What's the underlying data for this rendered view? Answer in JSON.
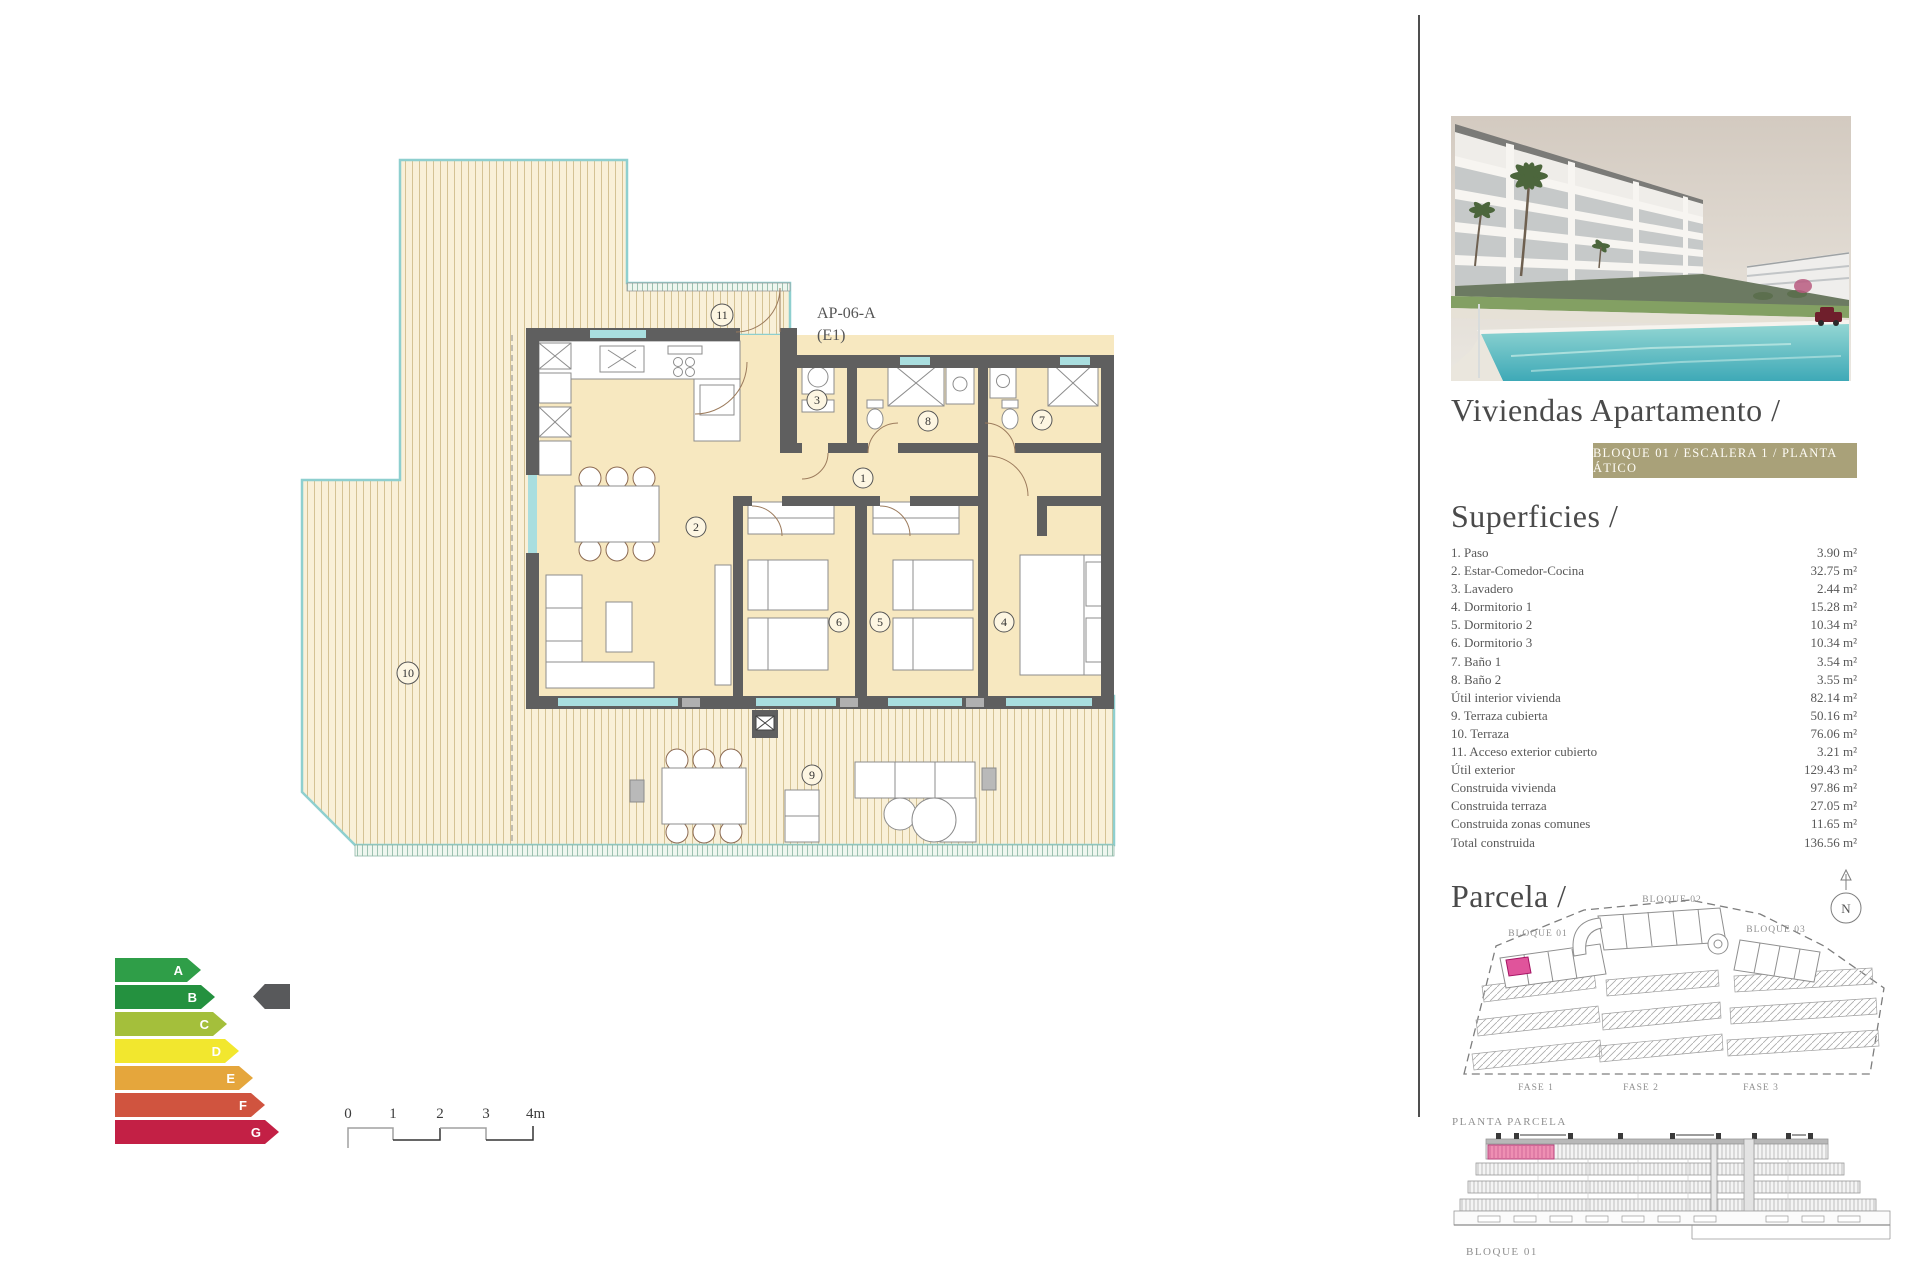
{
  "colors": {
    "badge_bg": "#a9a179",
    "highlight": "#e0549b",
    "highlight_light": "#ee8fb3",
    "wall": "#5f5f5f"
  },
  "plan": {
    "unit": "AP-06-A",
    "unit_floor": "(E1)",
    "numbers": [
      "1",
      "2",
      "3",
      "4",
      "5",
      "6",
      "7",
      "8",
      "9",
      "10",
      "11"
    ]
  },
  "energy": {
    "grades": [
      {
        "letter": "A",
        "color": "#2f9e48",
        "width": 86
      },
      {
        "letter": "B",
        "color": "#24913f",
        "width": 100
      },
      {
        "letter": "C",
        "color": "#a4bf3b",
        "width": 112
      },
      {
        "letter": "D",
        "color": "#f2e72e",
        "width": 124
      },
      {
        "letter": "E",
        "color": "#e5a63c",
        "width": 138
      },
      {
        "letter": "F",
        "color": "#d0543f",
        "width": 150
      },
      {
        "letter": "G",
        "color": "#c32045",
        "width": 164
      }
    ],
    "indicator_color": "#58595b",
    "rating": "B"
  },
  "scale": {
    "labels": [
      "0",
      "1",
      "2",
      "3",
      "4m"
    ]
  },
  "panel": {
    "title": "Viviendas Apartamento /",
    "badge": "BLOQUE 01 / ESCALERA 1 / PLANTA ÁTICO",
    "superficies": {
      "heading": "Superficies /",
      "rows": [
        {
          "label": "1. Paso",
          "value": "3.90 m²"
        },
        {
          "label": "2. Estar-Comedor-Cocina",
          "value": "32.75 m²"
        },
        {
          "label": "3. Lavadero",
          "value": "2.44 m²"
        },
        {
          "label": "4. Dormitorio 1",
          "value": "15.28 m²"
        },
        {
          "label": "5. Dormitorio 2",
          "value": "10.34 m²"
        },
        {
          "label": "6. Dormitorio 3",
          "value": "10.34 m²"
        },
        {
          "label": "7. Baño 1",
          "value": "3.54 m²"
        },
        {
          "label": "8. Baño 2",
          "value": "3.55 m²"
        },
        {
          "label": "Útil interior vivienda",
          "value": "82.14 m²"
        },
        {
          "label": "9. Terraza cubierta",
          "value": "50.16 m²"
        },
        {
          "label": "10. Terraza",
          "value": "76.06 m²"
        },
        {
          "label": "11. Acceso exterior cubierto",
          "value": "3.21 m²"
        },
        {
          "label": "Útil exterior",
          "value": "129.43 m²"
        },
        {
          "label": "Construida vivienda",
          "value": "97.86 m²"
        },
        {
          "label": "Construida terraza",
          "value": "27.05 m²"
        },
        {
          "label": "Construida zonas comunes",
          "value": "11.65 m²"
        },
        {
          "label": "Total construida",
          "value": "136.56 m²"
        }
      ]
    },
    "parcela": {
      "heading": "Parcela /",
      "blocks": [
        "BLOQUE 01",
        "BLOQUE 02",
        "BLOQUE 03"
      ],
      "fases": [
        "FASE 1",
        "FASE 2",
        "FASE 3"
      ],
      "caption": "PLANTA PARCELA",
      "compass": "N"
    },
    "elevation": {
      "caption": "BLOQUE 01"
    }
  }
}
